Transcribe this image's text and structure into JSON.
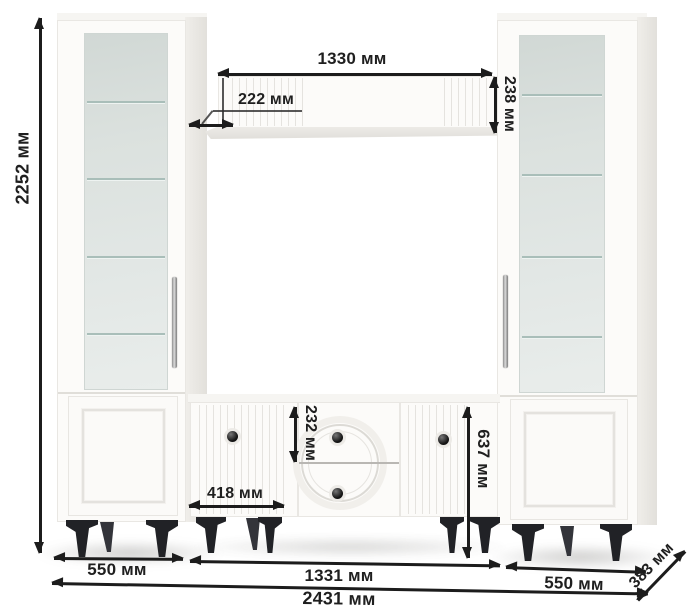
{
  "figure": {
    "kind": "furniture dimension diagram",
    "unit": "мм"
  },
  "dims": {
    "total_height": "2252 мм",
    "shelf_length": "1330 мм",
    "shelf_inset": "222 мм",
    "shelf_face_height": "238 мм",
    "drawer_height": "232 мм",
    "tv_stand_height": "637 мм",
    "tv_door_width": "418 мм",
    "left_cabinet_width": "550 мм",
    "center_width": "1331 мм",
    "right_cabinet_width": "550 мм",
    "total_width": "2431 мм",
    "depth": "383 мм"
  },
  "colors": {
    "dimension_line": "#1c1c1c",
    "label_text": "#1f1f1f",
    "furniture_white": "#fcfbf9",
    "glass_tint": "#dde3e0",
    "glass_shelf_line": "#a9beb9",
    "legs": "#212226"
  }
}
